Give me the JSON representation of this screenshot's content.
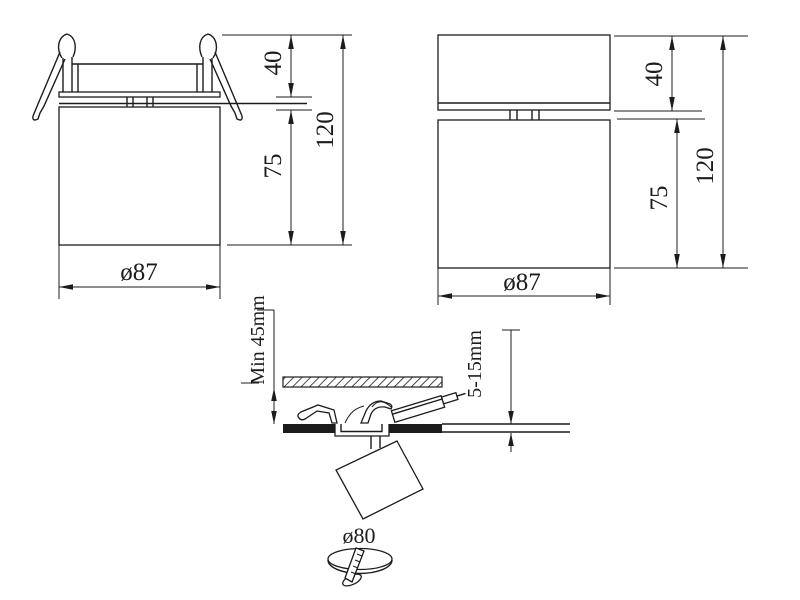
{
  "colors": {
    "line": "#1c1c1c",
    "background": "#ffffff",
    "ceiling_fill": "#1c1c1c"
  },
  "views": {
    "recessed": {
      "diameter": "ø87",
      "height_top": "40",
      "height_body": "75",
      "height_total": "120"
    },
    "surface": {
      "diameter": "ø87",
      "height_top": "40",
      "height_body": "75",
      "height_total": "120"
    },
    "installation": {
      "min_clearance": "Min 45mm",
      "ceiling_thickness": "5-15mm",
      "cutout_diameter": "ø80"
    }
  }
}
